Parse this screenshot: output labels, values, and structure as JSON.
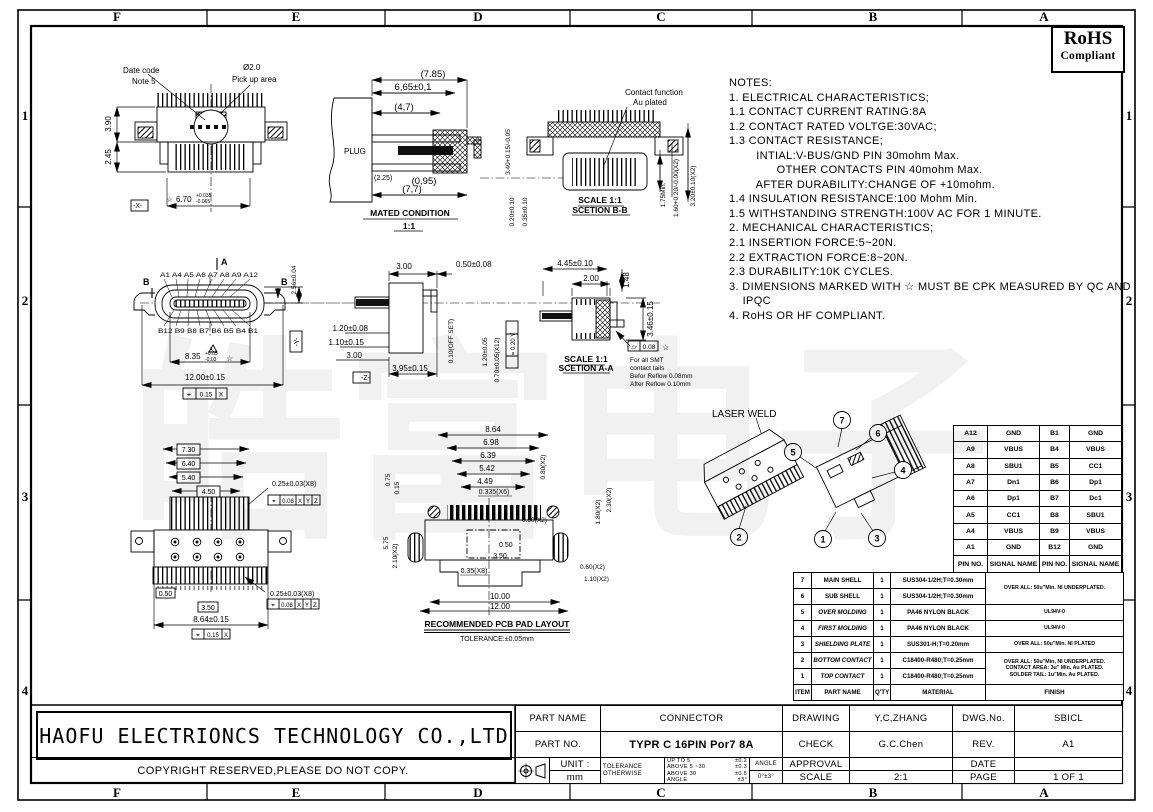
{
  "sheet": {
    "watermark": "皓富电子",
    "rohs": {
      "line1": "RoHS",
      "line2": "Compliant"
    },
    "zone_cols": [
      "F",
      "E",
      "D",
      "C",
      "B",
      "A"
    ],
    "zone_rows": [
      "1",
      "2",
      "3",
      "4"
    ]
  },
  "notes": {
    "lines": [
      "NOTES:",
      "1. ELECTRICAL CHARACTERISTICS;",
      "1.1 CONTACT CURRENT RATING:8A",
      "1.2 CONTACT RATED VOLTGE:30VAC;",
      "1.3 CONTACT RESISTANCE;",
      "        INTIAL:V-BUS/GND PIN 30mohm Max.",
      "              OTHER CONTACTS PIN 40mohm Max.",
      "        AFTER DURABILITY:CHANGE OF +10mohm.",
      "1.4 INSULATION RESISTANCE:100 Mohm Min.",
      "1.5 WITHSTANDING STRENGTH:100V AC FOR 1 MINUTE.",
      "2. MECHANICAL CHARACTERISTICS;",
      "2.1 INSERTION FORCE:5~20N.",
      "2.2 EXTRACTION FORCE:8~20N.",
      "2.3 DURABILITY:10K CYCLES.",
      "3. DIMENSIONS MARKED WITH ☆ MUST BE CPK MEASURED BY QC AND",
      "    IPQC",
      "4. RoHS OR HF COMPLIANT."
    ]
  },
  "views": {
    "v1": {
      "date_code": "Date code",
      "note5": "Note 5",
      "dia": "Ø2.0",
      "pickup": "Pick up area",
      "d390": "3.90",
      "d245": "2.45",
      "star": "☆",
      "d670": "6.70",
      "d670t": "+0.035",
      "d670b": "-0.065",
      "datum_x": "-X-"
    },
    "v2": {
      "d785": "(7.85)",
      "d665": "6,65±0,1",
      "d47": "(4,7)",
      "plug": "PLUG",
      "d225": "(2.25)",
      "d095": "(0,95)",
      "d77": "(7,7)",
      "cap": "MATED CONDITION",
      "scale": "1:1",
      "d340": "3.40+0.15/-0.05",
      "d020": "0.20±0.10",
      "d035": "0.35±0.10"
    },
    "v3": {
      "fn1": "Contact function",
      "fn2": "Au plated",
      "d175": "1.75Min.",
      "d160": "1.60+0.20/-0.00(X2)",
      "d320": "3.20±0.10(X2)",
      "cap1": "SCALE 1:1",
      "cap2": "SCETION B-B"
    },
    "v4": {
      "sec_a": "A",
      "sec_b": "B",
      "pins_top": "A1 A4 A5 A6 A7 A8 A9 A12",
      "pins_bot": "B12 B9 B8 B7 B6 B5 B4 B1",
      "d256": "2.56±0.04",
      "d835": "8.35",
      "d835t": "+0.05",
      "d835b": "-0.03",
      "star": "☆",
      "datum_a": "A",
      "d1200": "12.00±0.15",
      "fcf_sym": "⌖",
      "fcf_val": "0.15",
      "fcf_x": "X",
      "datum_y": "-Y-"
    },
    "v5": {
      "d300a": "3.00",
      "d050": "0.50±0.08",
      "d120": "1.20±0.08",
      "d110": "1.10±0.15",
      "d300b": "3.00",
      "d395": "3.95±0.15",
      "datum_z": "-Z-",
      "off": "0.10(OFF SET)",
      "d120b": "1.20±0.05",
      "d070": "0.70±0.05(X12)",
      "par": "= 0.20 Y"
    },
    "v6": {
      "d445": "4.45±0.10",
      "d200": "2.00",
      "d148": "1.48",
      "d346": "3.46±0.15",
      "flat_sym": "▱",
      "flat_val": "0.08",
      "star": "☆",
      "n1": "For all SMT",
      "n2": "contact tails",
      "n3": "Befor Reflow 0.08mm",
      "n4": "After Reflow 0.10mm",
      "cap1": "SCALE 1:1",
      "cap2": "SCETION A-A"
    },
    "v7": {
      "b730": "7.30",
      "b640": "6.40",
      "b540": "5.40",
      "b450": "4.50",
      "d025": "0.25±0.03(X8)",
      "fcf1_sym": "⌖",
      "fcf1_val": "0.08",
      "fx": "X",
      "fy": "Y",
      "fz": "Z",
      "b050": "0.50",
      "b350": "3.50",
      "d864": "8.64±0.15",
      "fcf2_sym": "⌖",
      "fcf2_val": "0.15"
    },
    "v8": {
      "d864": "8.64",
      "d698": "6.98",
      "d639": "6.39",
      "d542": "5.42",
      "d449": "4.49",
      "d0335": "0.335(X6)",
      "d080": "0.80(X2)",
      "d075": "0.75",
      "d015": "0.15",
      "d180": "1.80(X2)",
      "d230": "2.30(X2)",
      "d060a": "0.60(X2)",
      "d050": "0.50",
      "d350": "3.50",
      "d035": "0.35(X8)",
      "d210": "2.10(X2)",
      "d575": "5.75",
      "d060b": "0.60(X2)",
      "d110": "1.10(X2)",
      "d1000": "10.00",
      "d1200": "12.00",
      "cap1": "RECOMMENDED PCB PAD LAYOUT",
      "cap2": "TOLERANCE:±0.05mm"
    },
    "v9": {
      "laser": "LASER WELD",
      "n1": "1",
      "n2": "2",
      "n3": "3",
      "n4": "4",
      "n5": "5",
      "n6": "6",
      "n7": "7"
    }
  },
  "pin_table": {
    "header": [
      "PIN NO.",
      "SIGNAL NAME",
      "PIN NO.",
      "SIGNAL NAME"
    ],
    "rows": [
      [
        "A12",
        "GND",
        "B1",
        "GND"
      ],
      [
        "A9",
        "VBUS",
        "B4",
        "VBUS"
      ],
      [
        "A8",
        "SBU1",
        "B5",
        "CC1"
      ],
      [
        "A7",
        "Dn1",
        "B6",
        "Dp1"
      ],
      [
        "A6",
        "Dp1",
        "B7",
        "Dc1"
      ],
      [
        "A5",
        "CC1",
        "B8",
        "SBU1"
      ],
      [
        "A4",
        "VBUS",
        "B9",
        "VBUS"
      ],
      [
        "A1",
        "GND",
        "B12",
        "GND"
      ]
    ]
  },
  "bom": {
    "header": {
      "item": "ITEM",
      "name": "PART NAME",
      "qty": "Q'TY",
      "material": "MATERIAL",
      "finish": "FINISH"
    },
    "rows": [
      {
        "item": "7",
        "name": "MAIN SHELL",
        "qty": "1",
        "material": "SUS304-1/2H;T=0.30mm",
        "finish": "OVER ALL: 50u\"Min. NI UNDERPLATED."
      },
      {
        "item": "6",
        "name": "SUB SHELL",
        "qty": "1",
        "material": "SUS304-1/2H;T=0.30mm"
      },
      {
        "item": "5",
        "name": "OVER MOLDING",
        "qty": "1",
        "material": "PA46 NYLON BLACK",
        "finish": "UL94V-0"
      },
      {
        "item": "4",
        "name": "FIRST MOLDING",
        "qty": "1",
        "material": "PA46 NYLON BLACK",
        "finish": "UL94V-0"
      },
      {
        "item": "3",
        "name": "SHIELDING PLATE",
        "qty": "1",
        "material": "SUS301-H;T=0.20mm",
        "finish": "OVER ALL: 50u\"Min. NI PLATED"
      },
      {
        "item": "2",
        "name": "BOTTOM CONTACT",
        "qty": "1",
        "material": "C18400-R480;T=0.25mm",
        "finish": "OVER ALL: 50u\"Min, NI UNDERPLATED.\nCONTACT AREA: 3u\" Min. Au PLATED.\nSOLDER TAIL: 1u\"Min. Au PLATED."
      },
      {
        "item": "1",
        "name": "TOP CONTACT",
        "qty": "1",
        "material": "C18400-R480;T=0.25mm"
      }
    ]
  },
  "title_block": {
    "part_name_label": "PART NAME",
    "part_name": "CONNECTOR",
    "part_no_label": "PART NO.",
    "part_no": "TYPR C 16PIN Por7 8A",
    "drawing_label": "DRAWING",
    "drawing": "Y,C,ZHANG",
    "check_label": "CHECK",
    "check": "G.C.Chen",
    "dwg_no_label": "DWG.No.",
    "dwg_no": "SBICL",
    "rev_label": "REV.",
    "rev": "A1",
    "approval_label": "APPROVAL",
    "approval": "",
    "date_label": "DATE",
    "date": "",
    "scale_label": "SCALE",
    "scale": "2:1",
    "page_label": "PAGE",
    "page": "1 OF 1",
    "unit_label": "UNIT :",
    "unit": "mm",
    "tol_label1": "TOLERANCE",
    "tol_label2": "OTHERWISE",
    "tol_rows": [
      [
        "UP TO 5",
        "±0.2"
      ],
      [
        "ABOVE 5 ~30",
        "±0.3"
      ],
      [
        "ABOVE 30",
        "±0.5"
      ],
      [
        "ANGLE",
        "±3°"
      ]
    ],
    "angle_label": "ANGLE",
    "angle": "0°±3°"
  },
  "company": {
    "name": "HAOFU ELECTRIONCS TECHNOLOGY CO.,LTD",
    "copyright": "COPYRIGHT RESERVED,PLEASE DO NOT COPY."
  }
}
